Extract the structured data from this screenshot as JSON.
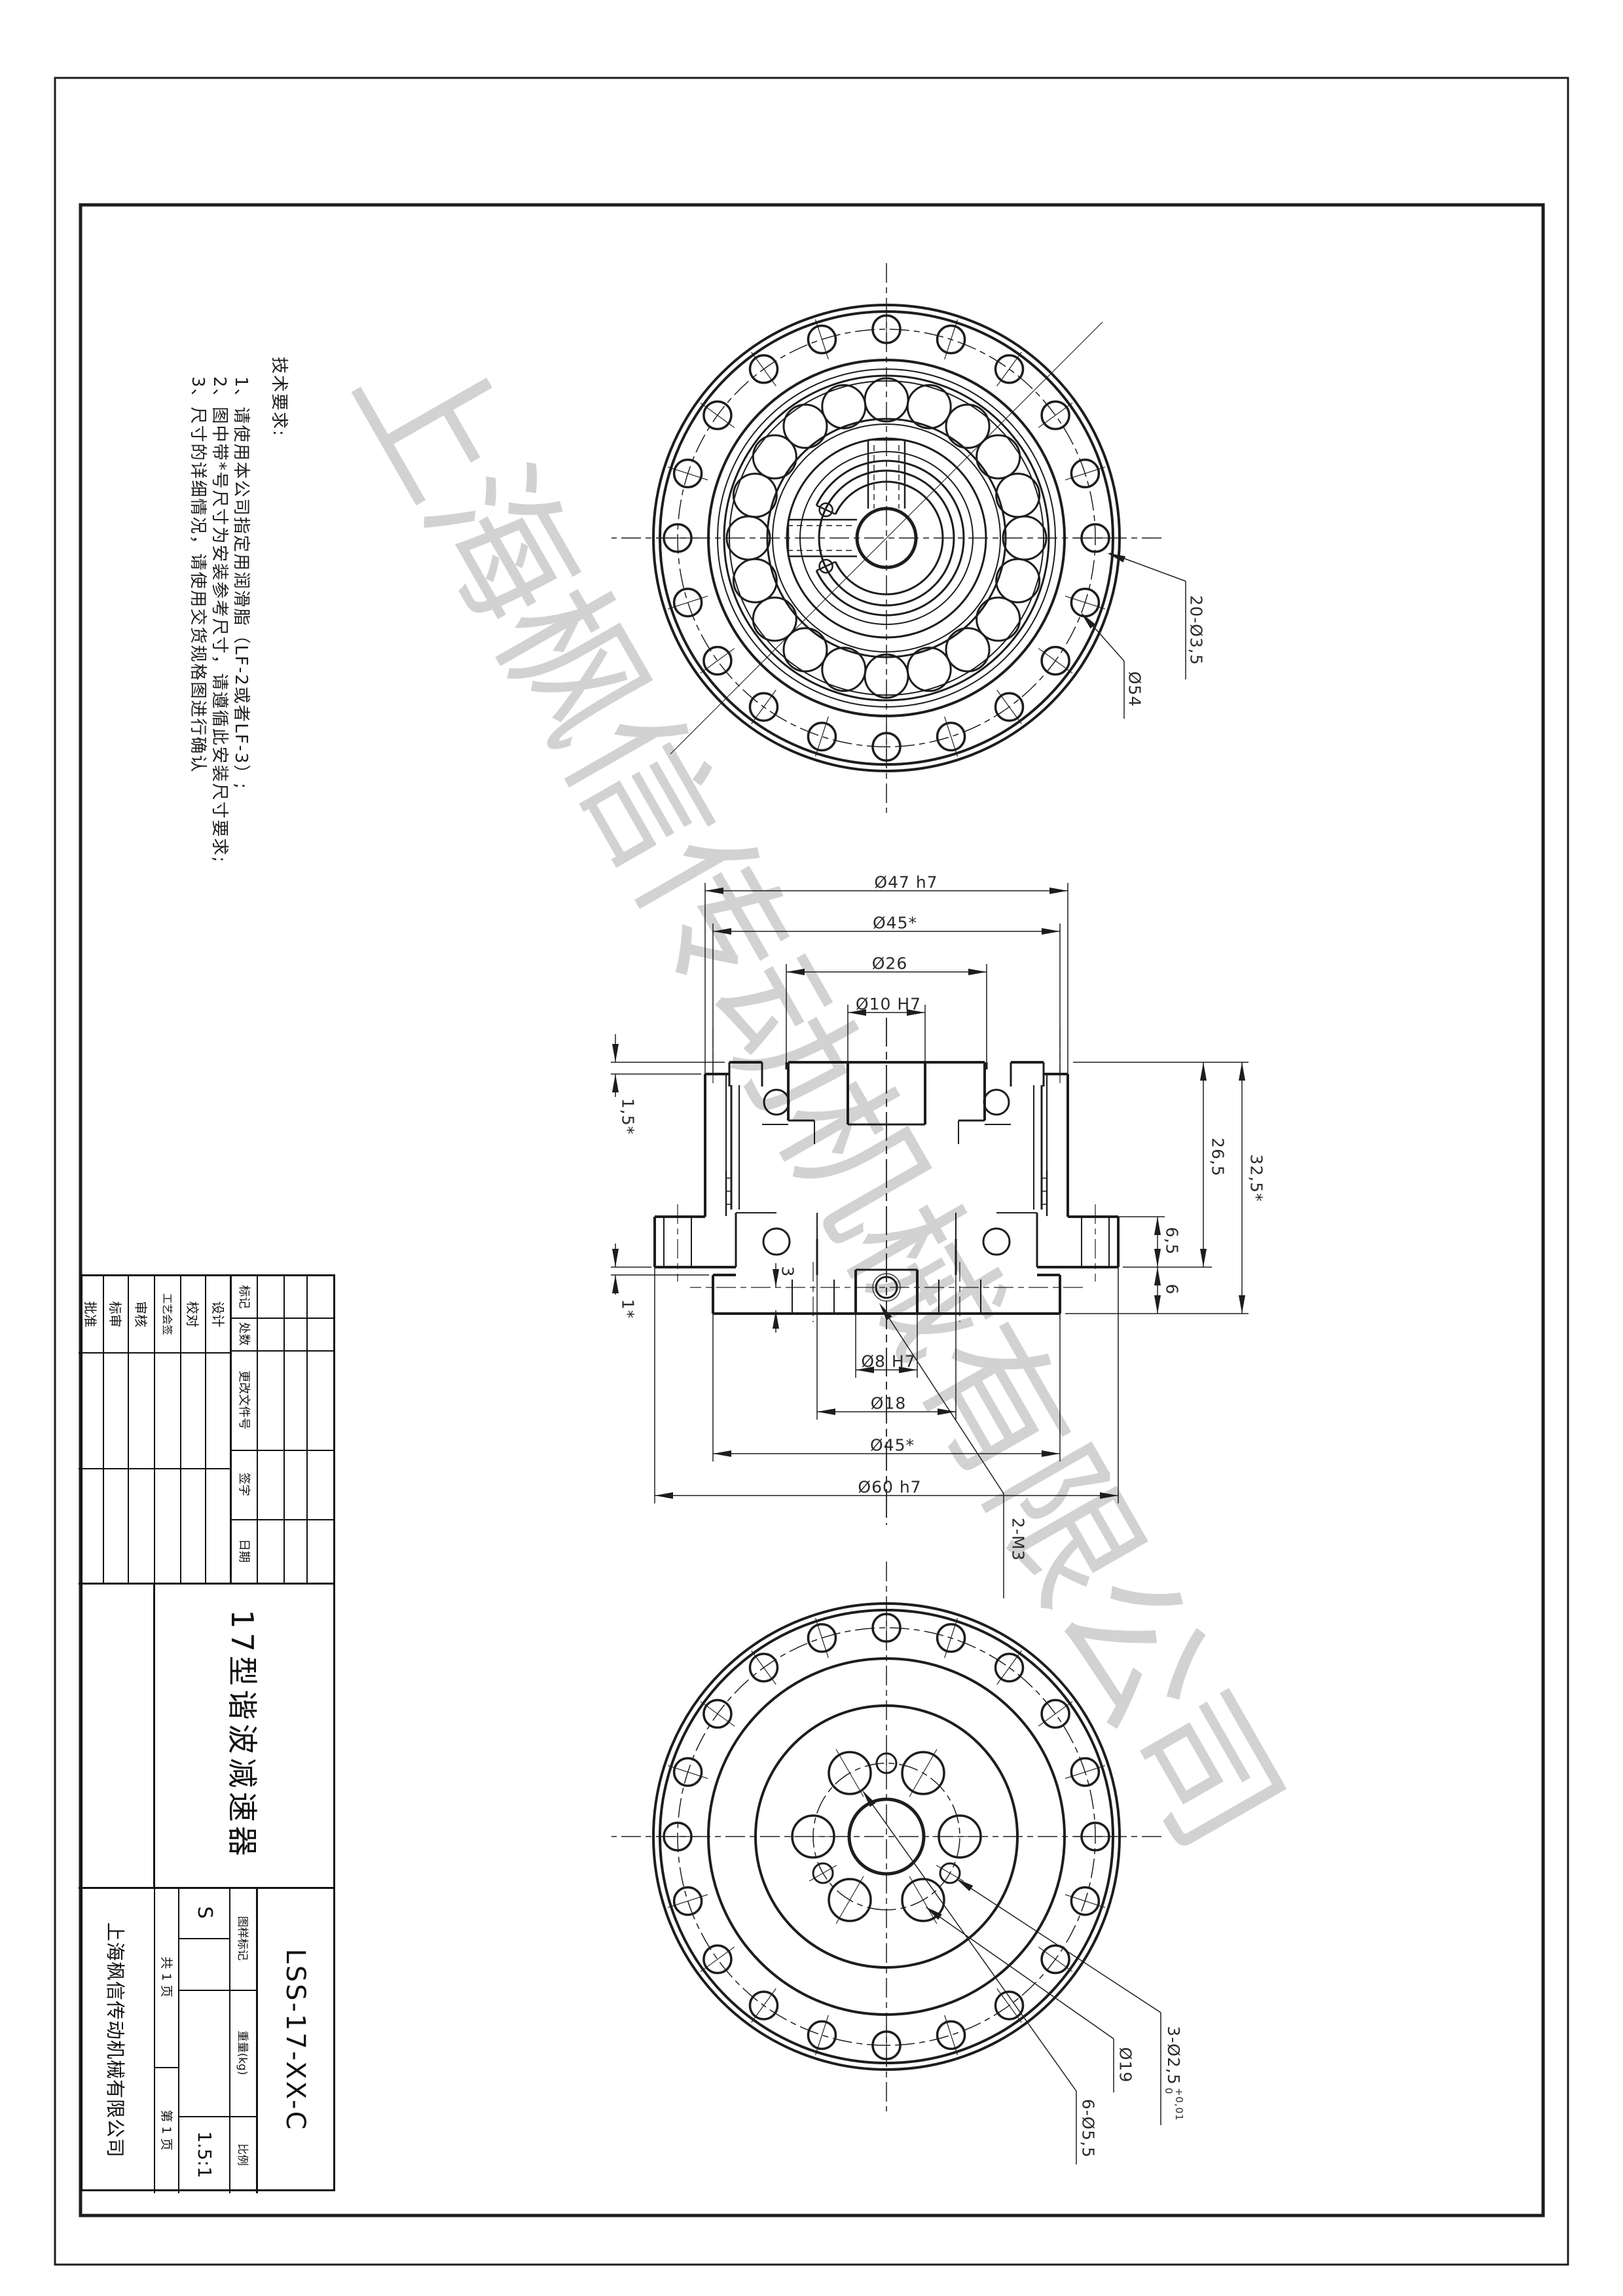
{
  "watermark": "上海枫信传动机械有限公司",
  "tech_notes": {
    "title": "技术要求:",
    "item1": "1、请使用本公司指定用润滑脂（LF-2或者LF-3）;",
    "item2": "2、图中带*号尺寸为安装参考尺寸，请遵循此安装尺寸要求;",
    "item3": "3、尺寸的详细情况，请使用交货规格图进行确认"
  },
  "left_view": {
    "holes_label": "20-Ø3,5",
    "bolt_circle_label": "Ø54"
  },
  "section_view": {
    "d47": "Ø47 h7",
    "d45_left": "Ø45*",
    "d26": "Ø26",
    "d10": "Ø10 H7",
    "d8": "Ø8 H7",
    "d18": "Ø18",
    "d45_right": "Ø45*",
    "d60": "Ø60 h7",
    "len_total": "32,5*",
    "len_26_5": "26,5",
    "len_6_5": "6,5",
    "len_6": "6",
    "len_1_5": "1,5*",
    "len_1": "1*",
    "len_3": "3",
    "thread": "2-M3"
  },
  "right_view": {
    "pin_holes_label": "3-Ø2,5",
    "pin_tol_upper": "+0,01",
    "pin_tol_lower": "0",
    "bolt_circle_label": "Ø19",
    "holes_label": "6-Ø5,5"
  },
  "title_block": {
    "rev_headers": [
      "标记",
      "处数",
      "更改文件号",
      "签字",
      "日期"
    ],
    "sign_rows": [
      "设计",
      "校对",
      "工艺会签",
      "审核",
      "标审",
      "批准"
    ],
    "part_name": "17型谐波减速器",
    "drawing_no": "LSS-17-XX-C",
    "stage_header": "图样标记",
    "weight_header": "重量(kg)",
    "scale_header": "比例",
    "stage_value": "S",
    "scale_value": "1.5:1",
    "sheet_total": "共 1 页",
    "sheet_no": "第 1 页",
    "company": "上海枫信传动机械有限公司"
  }
}
